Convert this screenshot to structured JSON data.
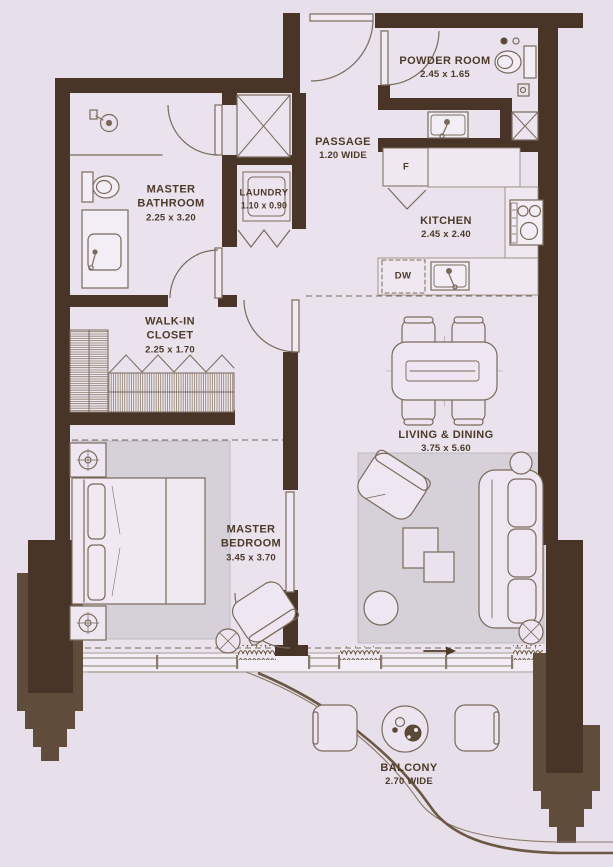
{
  "rooms": {
    "powder_room": {
      "name": "POWDER ROOM",
      "dims": "2.45 x 1.65"
    },
    "passage": {
      "name": "PASSAGE",
      "dims": "1.20 WIDE"
    },
    "laundry": {
      "name": "LAUNDRY",
      "dims": "1.10 x 0.90"
    },
    "master_bathroom": {
      "name": "MASTER\nBATHROOM",
      "dims": "2.25 x 3.20"
    },
    "kitchen": {
      "name": "KITCHEN",
      "dims": "2.45 x 2.40"
    },
    "walk_in_closet": {
      "name": "WALK-IN\nCLOSET",
      "dims": "2.25 x 1.70"
    },
    "living_dining": {
      "name": "LIVING & DINING",
      "dims": "3.75 x 5.60"
    },
    "master_bedroom": {
      "name": "MASTER\nBEDROOM",
      "dims": "3.45 x 3.70"
    },
    "balcony": {
      "name": "BALCONY",
      "dims": "2.70 WIDE"
    }
  },
  "appliances": {
    "fridge_label": "F",
    "dishwasher_label": "DW"
  },
  "colors": {
    "wall": "#483527",
    "wall_light": "#5f4c3b",
    "background": "#e7dfe9",
    "floor": "#eae2ec",
    "rug": "#d6d1d8",
    "counter": "#efe8f1",
    "outline": "#7b6a5c",
    "text": "#4c3a2a"
  }
}
